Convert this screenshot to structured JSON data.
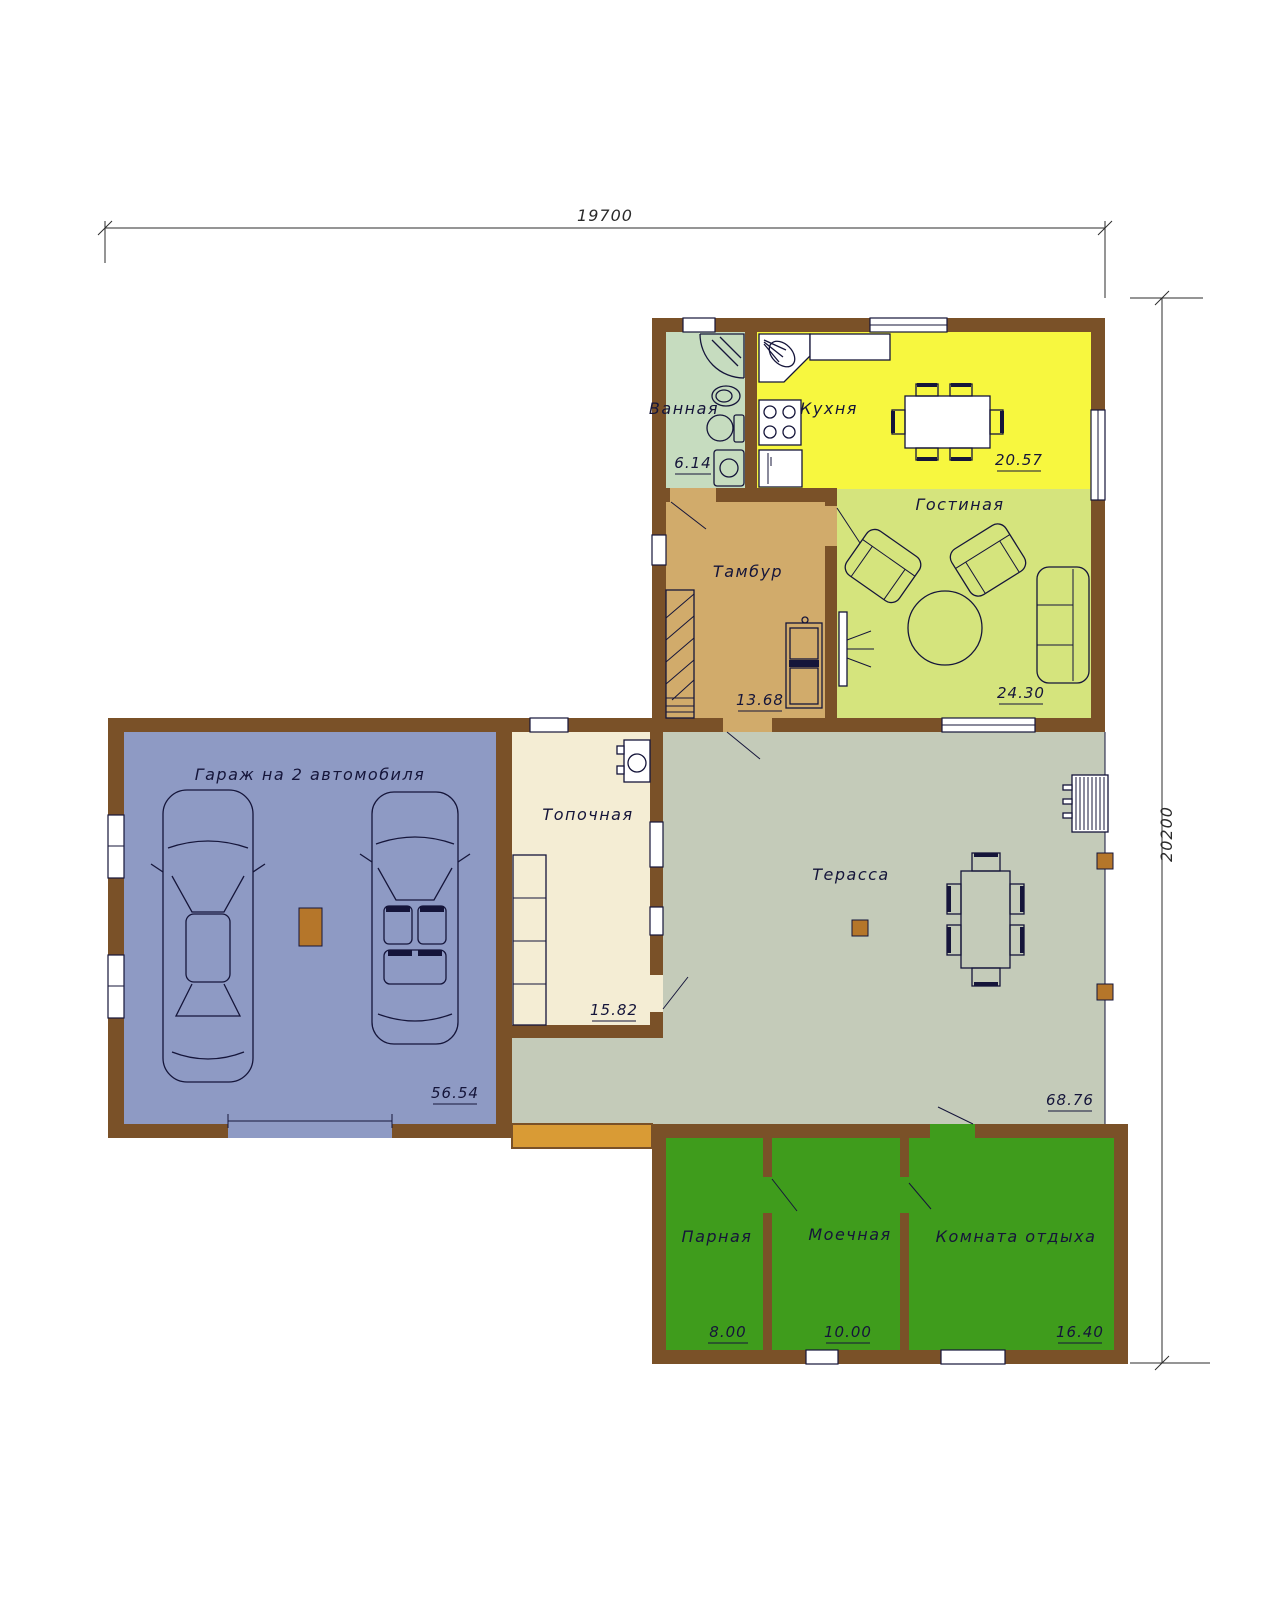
{
  "dimensions": {
    "width_mm": "19700",
    "height_mm": "20200"
  },
  "rooms": [
    {
      "id": "bathroom",
      "name": "Ванная",
      "area": "6.14"
    },
    {
      "id": "kitchen",
      "name": "Кухня",
      "area": "20.57"
    },
    {
      "id": "living-room",
      "name": "Гостиная",
      "area": "24.30"
    },
    {
      "id": "vestibule",
      "name": "Тамбур",
      "area": "13.68"
    },
    {
      "id": "garage",
      "name": "Гараж на 2 автомобиля",
      "area": "56.54"
    },
    {
      "id": "boiler-room",
      "name": "Топочная",
      "area": "15.82"
    },
    {
      "id": "terrace",
      "name": "Терасса",
      "area": "68.76"
    },
    {
      "id": "steam-room",
      "name": "Парная",
      "area": "8.00"
    },
    {
      "id": "washing-room",
      "name": "Моечная",
      "area": "10.00"
    },
    {
      "id": "rest-room",
      "name": "Комната отдыха",
      "area": "16.40"
    }
  ],
  "colors": {
    "wall": "#7a5128",
    "bathroom": "#c6dcbf",
    "kitchen": "#f7f73f",
    "living_room": "#d5e47d",
    "vestibule": "#d1ab6b",
    "garage": "#8e9ac4",
    "boiler_room": "#f4edd4",
    "terrace": "#c4cbb9",
    "sauna_rooms": "#3f9c1c",
    "terrace_step": "#d99b35",
    "line": "#15153a"
  }
}
